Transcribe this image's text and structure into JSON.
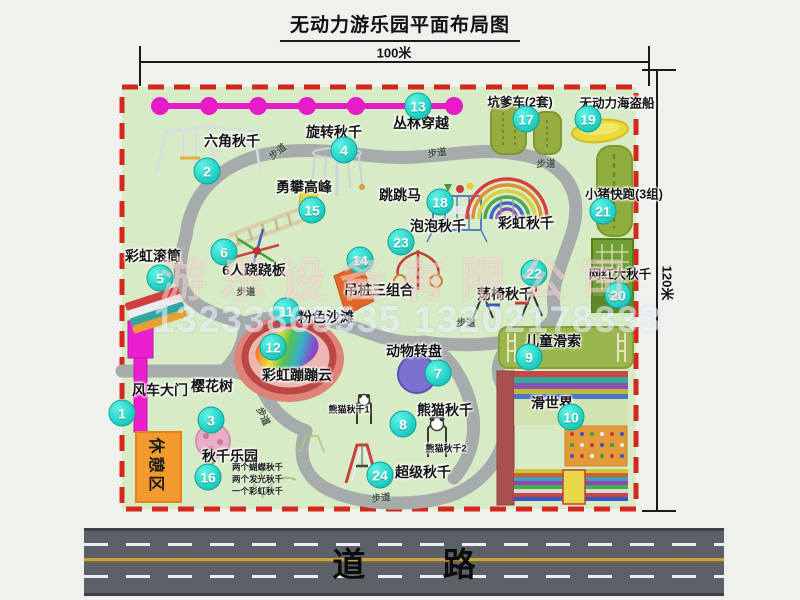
{
  "title": "无动力游乐园平面布局图",
  "dimensions": {
    "top": "100米",
    "right": "120米"
  },
  "road": {
    "label": "道 路"
  },
  "watermark": {
    "company": "游乐设备有限公司",
    "phone": "13233865535 13202178333"
  },
  "map": {
    "rest_area": "休憩区",
    "walkway_label": "步道",
    "rainbow_swing_label": "彩虹秋千",
    "panda_swing_1": "熊猫秋千1",
    "panda_swing_2": "熊猫秋千2",
    "swing_park_notes": {
      "n1": "两个蝴蝶秋千",
      "n2": "两个发光秋千",
      "n3": "一个彩虹秋千"
    },
    "attractions": [
      {
        "num": "1",
        "label": "风车大门"
      },
      {
        "num": "2",
        "label": "六角秋千"
      },
      {
        "num": "3",
        "label": "樱花树"
      },
      {
        "num": "4",
        "label": "旋转秋千"
      },
      {
        "num": "5",
        "label": "彩虹滚筒"
      },
      {
        "num": "6",
        "label": "6人跷跷板"
      },
      {
        "num": "7",
        "label": "动物转盘"
      },
      {
        "num": "8",
        "label": "熊猫秋千"
      },
      {
        "num": "9",
        "label": "儿童滑索"
      },
      {
        "num": "10",
        "label": "滑世界"
      },
      {
        "num": "11",
        "label": "粉色沙滩"
      },
      {
        "num": "12",
        "label": "彩虹蹦蹦云"
      },
      {
        "num": "13",
        "label": "丛林穿越"
      },
      {
        "num": "14",
        "label": "吊桩三组合"
      },
      {
        "num": "15",
        "label": "勇攀高峰"
      },
      {
        "num": "16",
        "label": "秋千乐园"
      },
      {
        "num": "17",
        "label": "坑爹车(2套)"
      },
      {
        "num": "18",
        "label": "跳跳马"
      },
      {
        "num": "19",
        "label": "无动力海盗船"
      },
      {
        "num": "20",
        "label": "网红大秋千"
      },
      {
        "num": "21",
        "label": "小猪快跑(3组)"
      },
      {
        "num": "22",
        "label": "荡椅秋千"
      },
      {
        "num": "23",
        "label": "泡泡秋千"
      },
      {
        "num": "24",
        "label": "超级秋千"
      }
    ]
  },
  "colors": {
    "map-bg": "#d7ecc6",
    "border-red": "#d5281c",
    "path-gray": "#a6acac",
    "badge-teal": "#24d2c6",
    "magenta": "#e61cc8",
    "road-gray": "#5c6168",
    "road-yellow": "#c9a23c",
    "rest-orange": "#f29a2e"
  }
}
